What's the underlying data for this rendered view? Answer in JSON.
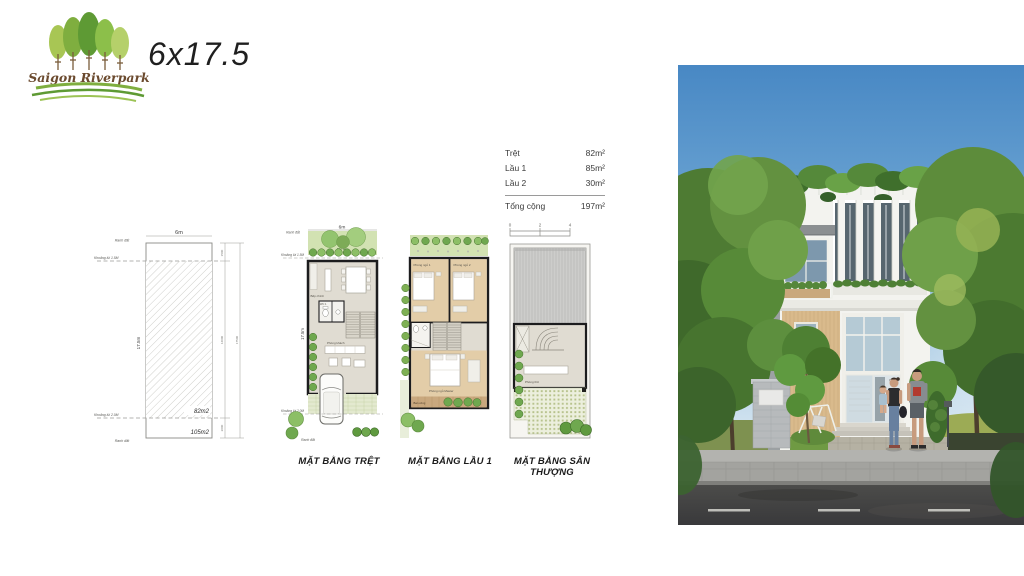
{
  "colors": {
    "brand_green": "#6BA43A",
    "logo_text_brown": "#6B4A2E",
    "ink": "#1B1B1B",
    "plan_wall": "#1C1C1E",
    "greenery": "#6FA84F",
    "sky_blue": "#4888C4"
  },
  "header": {
    "brand_name": "Saigon Riverpark",
    "plot_size_title": "6x17.5"
  },
  "site_plan": {
    "width_label": "6m",
    "depth_label": "17.5m",
    "boundary_top_label": "Ranh đất",
    "boundary_bottom_label": "Ranh đất",
    "setback_front_label": "Khoảng lùi 1.5M",
    "setback_rear_label": "Khoảng lùi 2.0M",
    "built_area_label": "82m2",
    "lot_area_label": "105m2",
    "dim_segment_top": "1500",
    "dim_segment_mid": "14000",
    "dim_segment_bottom": "2000",
    "dim_total": "17500"
  },
  "area_table": {
    "rows": [
      {
        "label": "Trệt",
        "value": "82m²"
      },
      {
        "label": "Lầu 1",
        "value": "85m²"
      },
      {
        "label": "Lầu 2",
        "value": "30m²"
      }
    ],
    "total_label": "Tổng cộng",
    "total_value": "197m²",
    "scale_ticks": [
      "0",
      "2",
      "4"
    ]
  },
  "ground_plan": {
    "title": "MẶT BẰNG TRỆT",
    "width_label": "6m",
    "depth_label": "17.5m",
    "boundary_top_label": "Ranh đất",
    "boundary_bottom_label": "Ranh đất",
    "setback_front_label": "Khoảng lùi 1.5M",
    "setback_rear_label": "Khoảng lùi 2.0M",
    "backyard_label": "Sân sau",
    "kitchen_label": "Bếp chính",
    "wc_label": "WC 1",
    "living_label": "Phòng khách"
  },
  "first_floor_plan": {
    "title": "MẶT BẰNG LẦU 1",
    "bedroom1_label": "Phòng ngủ 1",
    "bedroom2_label": "Phòng ngủ 2",
    "master_label": "Phòng ngủ Master",
    "balcony_label": "Ban công"
  },
  "roof_plan": {
    "title": "MẶT BẰNG SÂN THƯỢNG",
    "worship_label": "Phòng thờ"
  }
}
